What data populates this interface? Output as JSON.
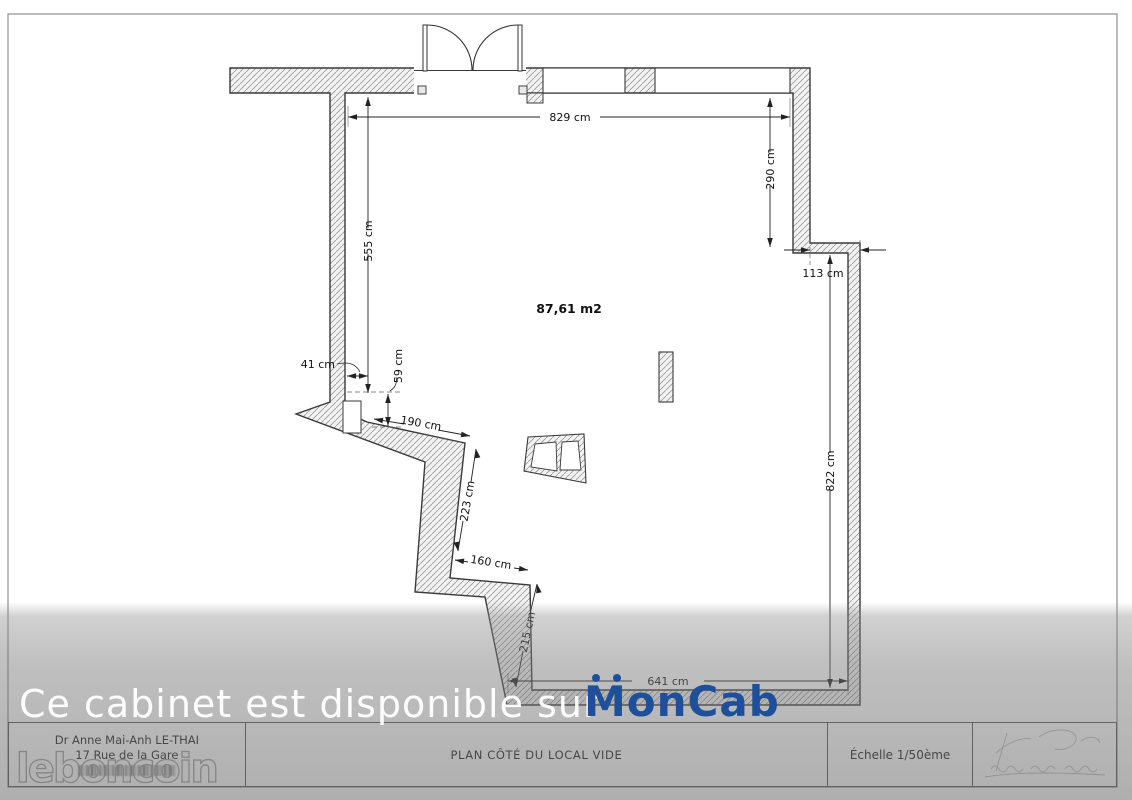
{
  "watermark": {
    "headline": "Ce cabinet est disponible sur",
    "brand": "MonCab",
    "brand_color": "#1d4f9a",
    "corner_brand": "leboncoin"
  },
  "plan": {
    "area_label": "87,61 m2",
    "dimensions": {
      "top_width": "829 cm",
      "left_height": "555 cm",
      "right_upper_height": "290 cm",
      "right_recess_width": "113 cm",
      "right_height": "822 cm",
      "bottom_width": "641 cm",
      "left_stub_width": "41 cm",
      "left_stub_height": "59 cm",
      "diagonal_width": "190 cm",
      "mid_left_height": "223 cm",
      "step_width": "160 cm",
      "lower_left_height": "215 cm"
    },
    "icons": {
      "double_door": "double-swing-door-icon",
      "column": "hatched-column-icon",
      "fixture": "hatched-fixture-icon",
      "signature": "architect-script-signature-icon"
    }
  },
  "title_block": {
    "address_line1": "Dr Anne Mai-Anh LE-THAI",
    "address_line2": "17 Rue de la Gare",
    "address_line3_pixelated": true,
    "drawing_title": "PLAN CÔTÉ DU LOCAL VIDE",
    "scale_label": "Échelle 1/50ème"
  }
}
